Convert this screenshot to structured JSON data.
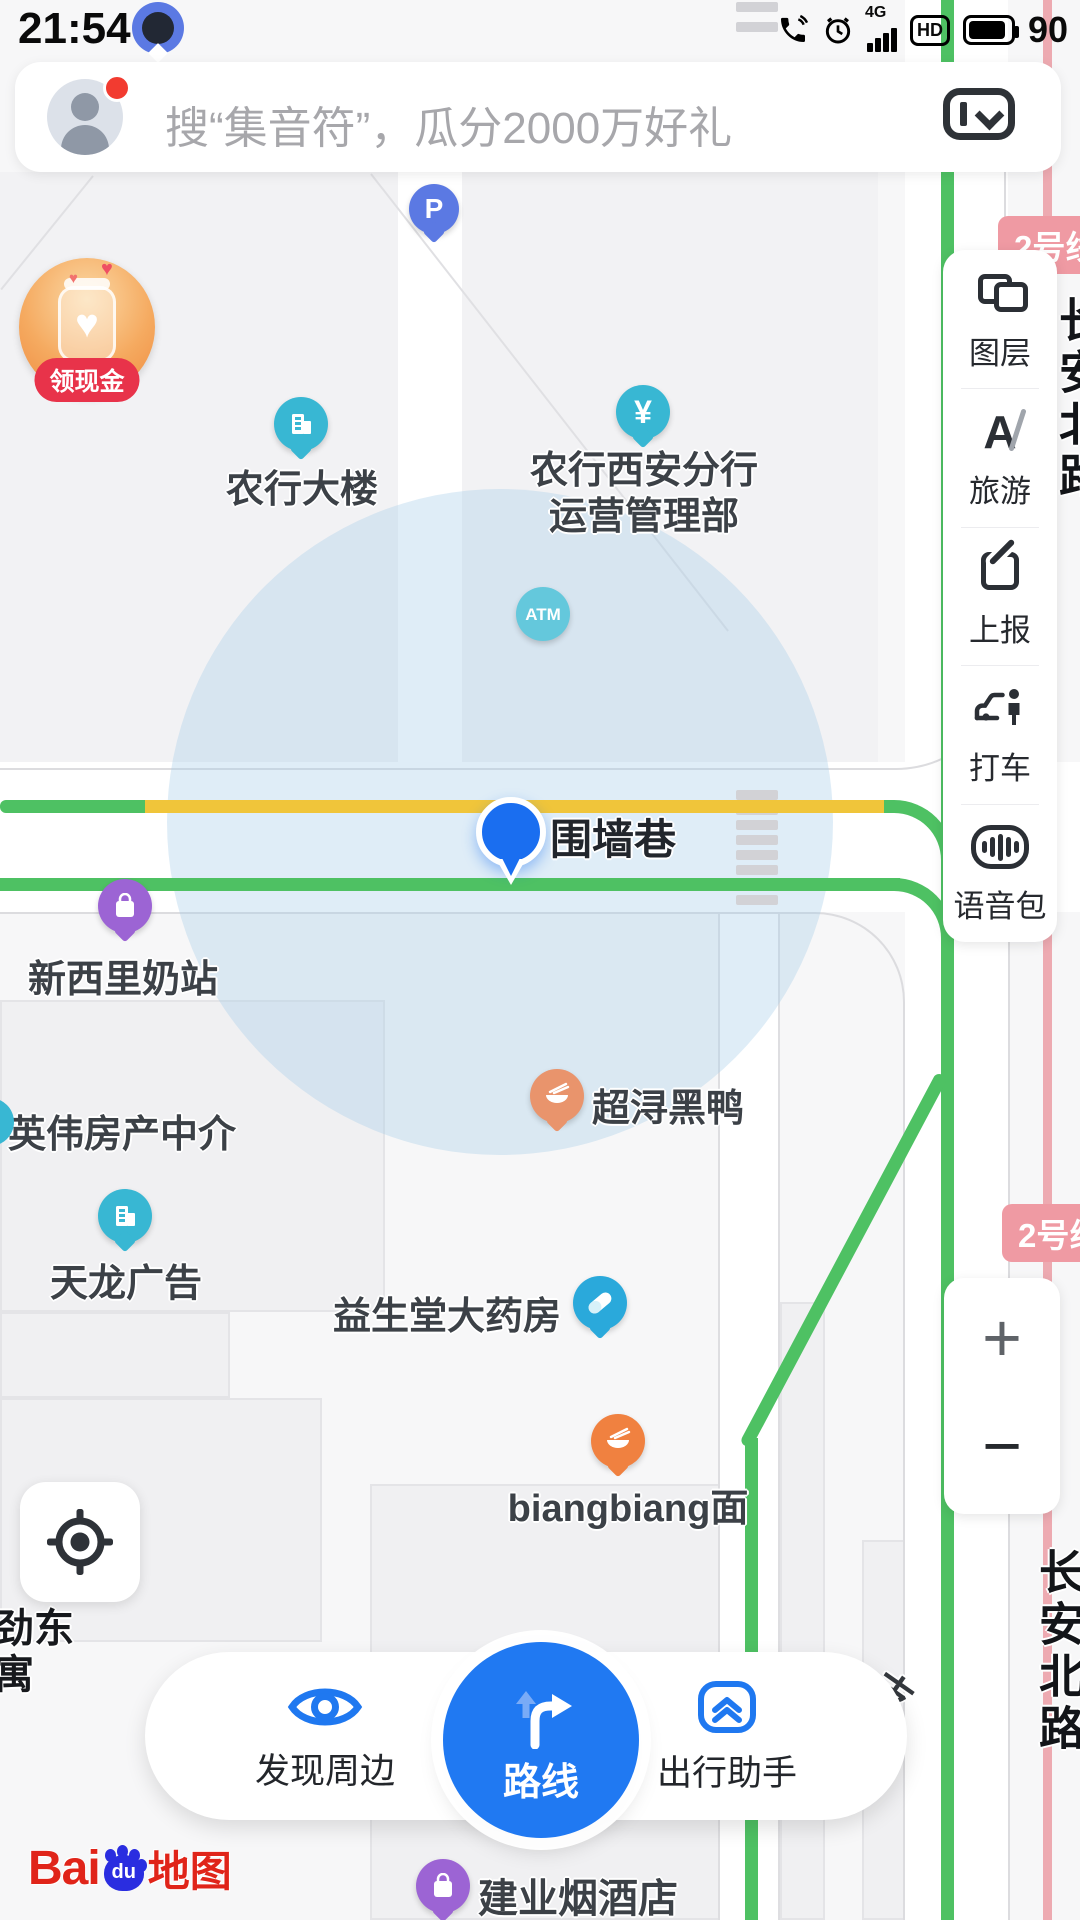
{
  "status_bar": {
    "time": "21:54",
    "network": "4G",
    "hd_label": "HD",
    "battery": "90"
  },
  "search": {
    "placeholder": "搜“集音符”，瓜分2000万好礼"
  },
  "promo": {
    "badge": "领现金"
  },
  "side_toolbar": {
    "items": [
      {
        "label": "图层",
        "icon": "layers-icon"
      },
      {
        "label": "旅游",
        "icon": "travel-icon"
      },
      {
        "label": "上报",
        "icon": "report-icon"
      },
      {
        "label": "打车",
        "icon": "taxi-icon"
      },
      {
        "label": "语音包",
        "icon": "voice-pack-icon"
      }
    ]
  },
  "zoom_controls": {
    "zoom_in": "+",
    "zoom_out": "−"
  },
  "map": {
    "metro_badge": "2号线",
    "current_location": {
      "road_label": "围墙巷"
    },
    "pois": {
      "parking": {
        "glyph": "P"
      },
      "atm": {
        "glyph": "ATM"
      },
      "yuan_glyph": "¥",
      "bank_building": {
        "label": "农行大楼"
      },
      "bank_branch": {
        "line1": "农行西安分行",
        "line2": "运营管理部"
      },
      "milk_station": {
        "label": "新西里奶站"
      },
      "realty": {
        "label": "英伟房产中介"
      },
      "tianlong_ad": {
        "label": "天龙广告"
      },
      "duck_shop": {
        "label": "超浔黑鸭"
      },
      "pharmacy": {
        "label": "益生堂大药房"
      },
      "noodle_shop": {
        "label": "biangbiang面"
      },
      "tobacco_shop": {
        "label": "建业烟酒店"
      },
      "apartment": {
        "line1": "劲东",
        "line2": "寓"
      },
      "road_name_right_top": "长安北路",
      "road_name_right_bottom": "长安北路",
      "branch_char": "支"
    }
  },
  "bottom_nav": {
    "discover": "发现周边",
    "route": "路线",
    "assistant": "出行助手"
  },
  "logo": {
    "bai": "Bai",
    "du": "du",
    "word": "地图"
  }
}
